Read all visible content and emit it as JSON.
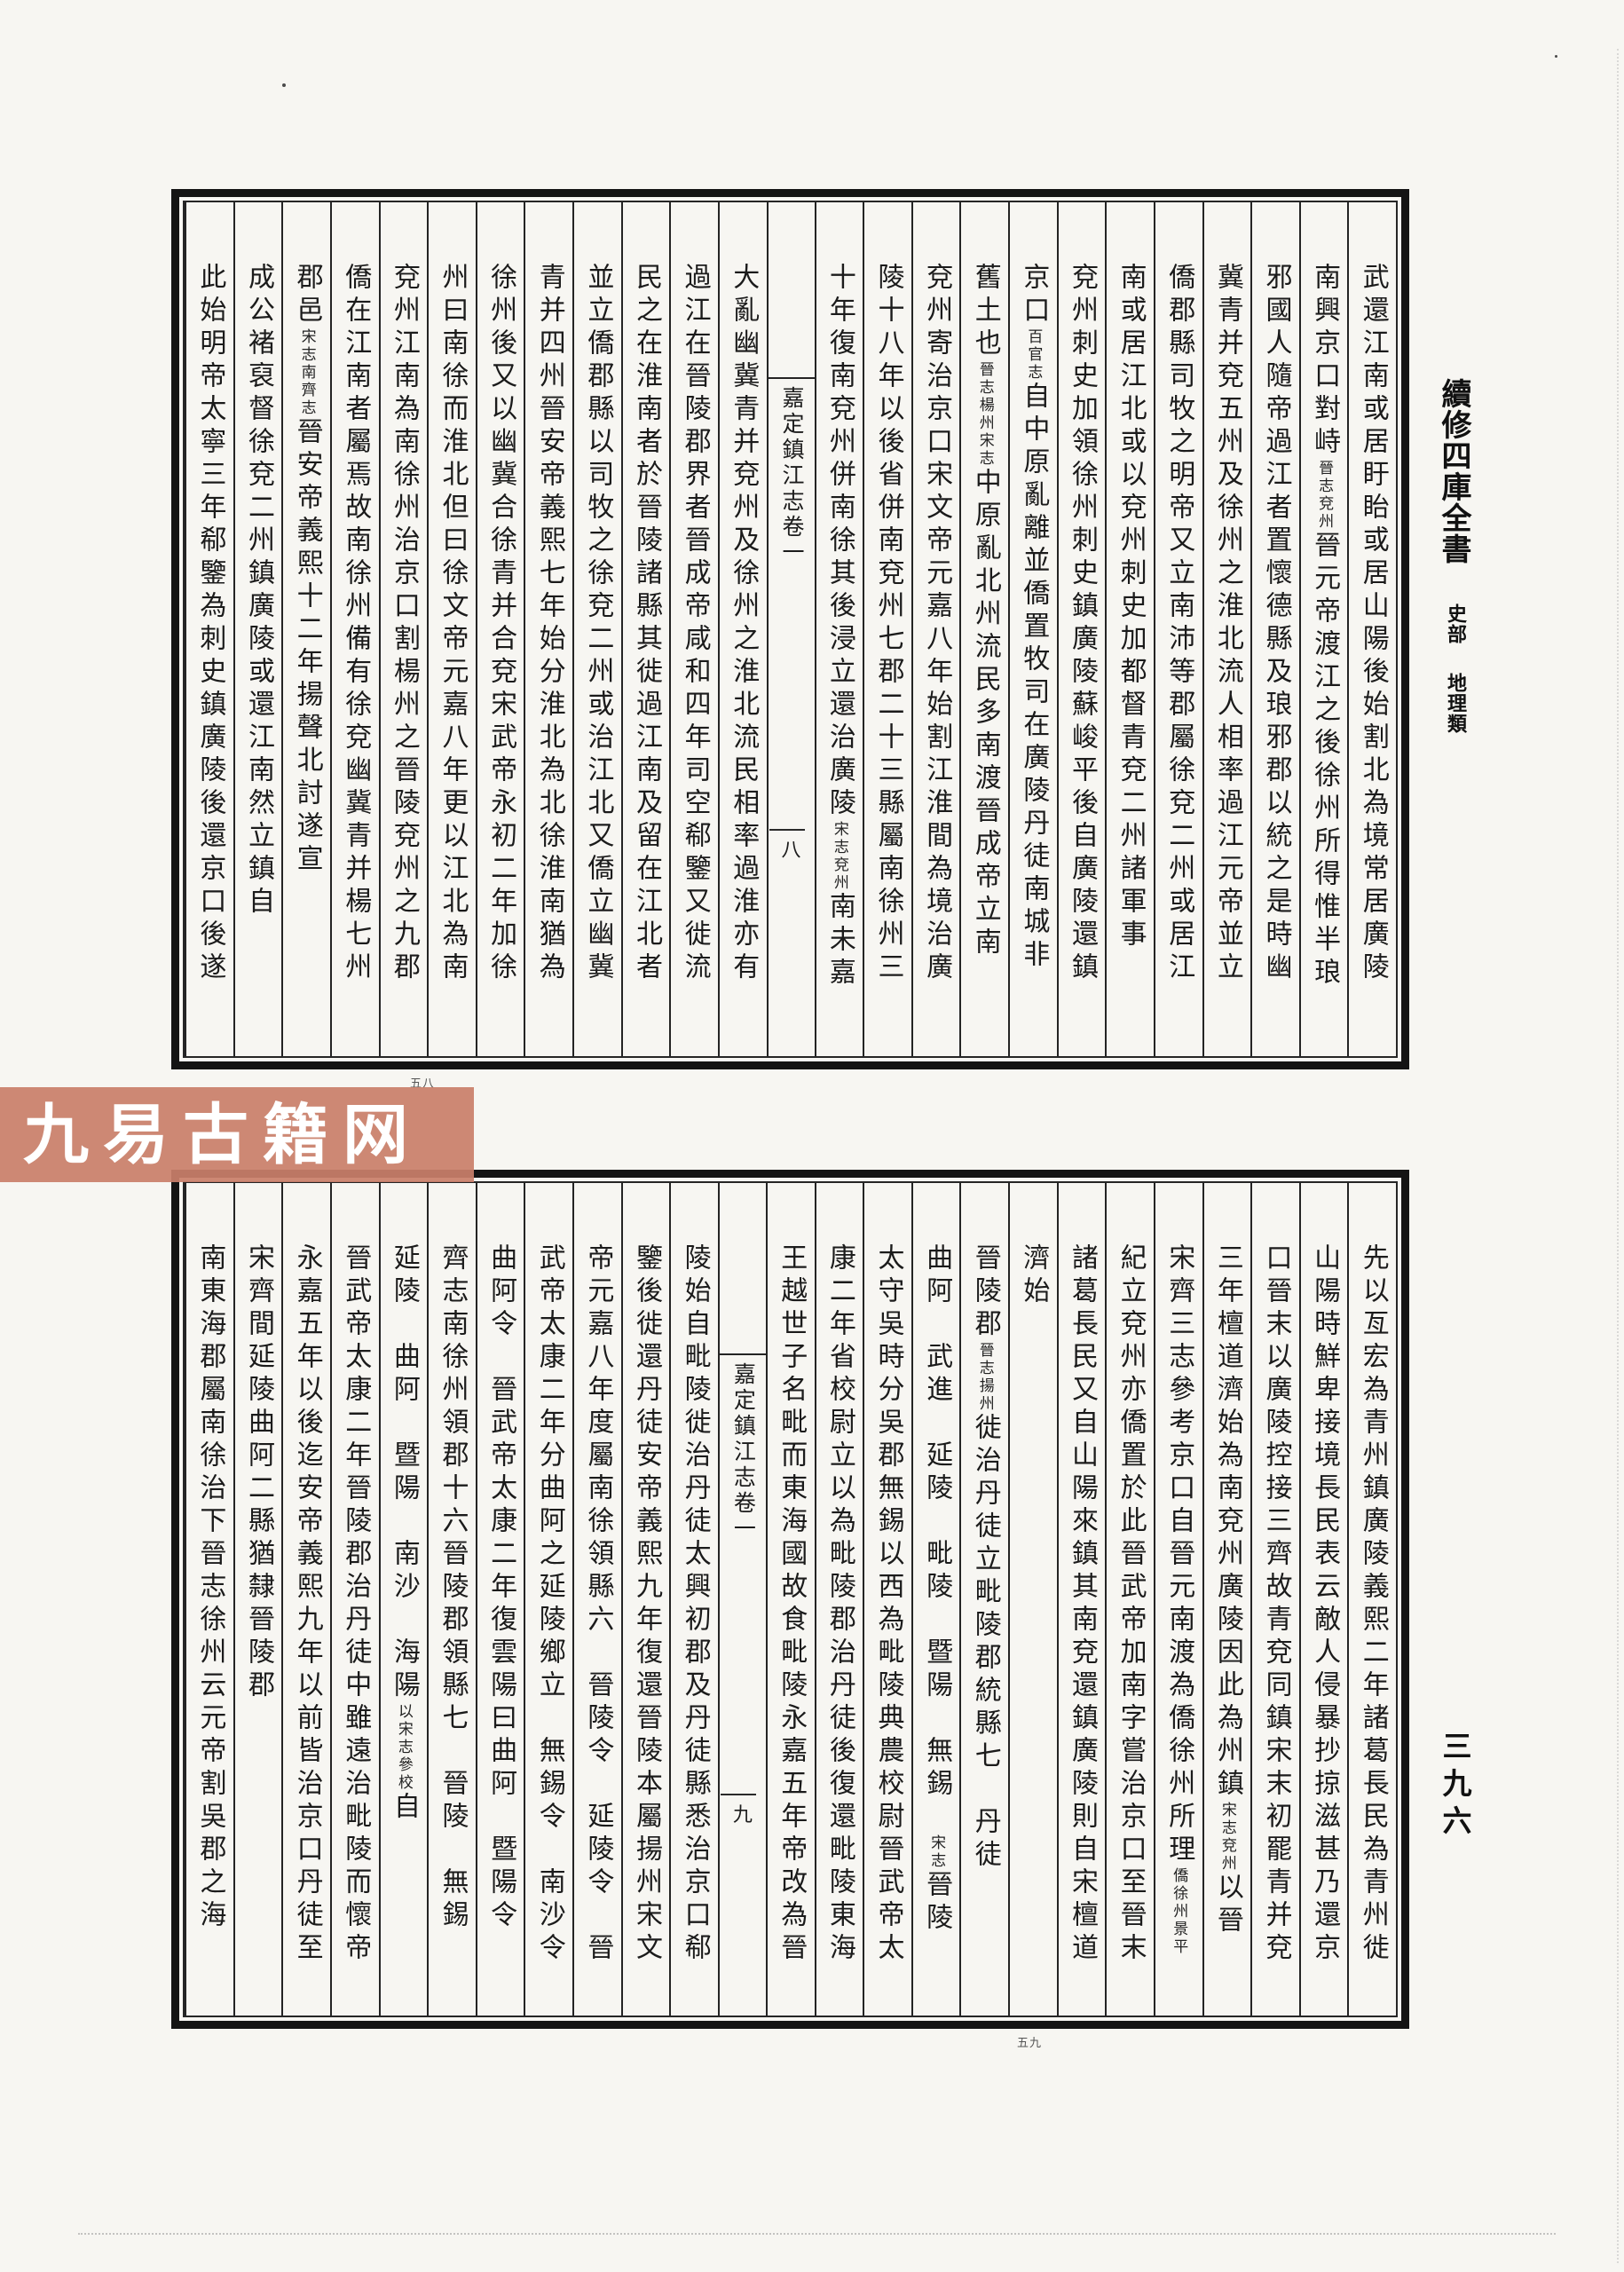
{
  "page": {
    "background": "#f7f6f2",
    "ink": "#1b1b1b"
  },
  "margin": {
    "series_title": "續修四庫全書",
    "section": "史部",
    "category": "地理類",
    "page_number": "三九六"
  },
  "watermark": {
    "text": "九易古籍网",
    "background": "#c97f6a",
    "foreground": "#ffffff"
  },
  "frames": [
    {
      "name": "upper",
      "fold_title": "嘉定鎮江志卷一",
      "fold_leaf_number": "八",
      "under_mark": "五八",
      "columns": [
        {
          "segs": [
            {
              "t": "武還江南或居盱眙或居山陽後始割北為境常居廣陵"
            }
          ]
        },
        {
          "segs": [
            {
              "t": "南興京口對峙"
            },
            {
              "t": "晉志兗州",
              "s": 1
            },
            {
              "t": "晉元帝渡江之後徐州所得惟半琅"
            }
          ]
        },
        {
          "segs": [
            {
              "t": "邪國人隨帝過江者置懷德縣及琅邪郡以統之是時幽"
            }
          ]
        },
        {
          "segs": [
            {
              "t": "冀青并兗五州及徐州之淮北流人相率過江元帝並立"
            }
          ]
        },
        {
          "segs": [
            {
              "t": "僑郡縣司牧之明帝又立南沛等郡屬徐兗二州或居江"
            }
          ]
        },
        {
          "segs": [
            {
              "t": "南或居江北或以兗州刺史加都督青兗二州諸軍事"
            }
          ]
        },
        {
          "segs": [
            {
              "t": "兗州刺史加領徐州刺史鎮廣陵蘇峻平後自廣陵還鎮"
            }
          ]
        },
        {
          "segs": [
            {
              "t": "京口"
            },
            {
              "t": "百官志",
              "s": 1
            },
            {
              "t": "自中原亂離並僑置牧司在廣陵丹徒南城非"
            }
          ]
        },
        {
          "segs": [
            {
              "t": "舊土也"
            },
            {
              "t": "晉志楊州宋志",
              "s": 1
            },
            {
              "t": "中原亂北州流民多南渡晉成帝立南"
            }
          ]
        },
        {
          "segs": [
            {
              "t": "兗州寄治京口宋文帝元嘉八年始割江淮間為境治廣"
            }
          ]
        },
        {
          "segs": [
            {
              "t": "陵十八年以後省併南兗州七郡二十三縣屬南徐州三"
            }
          ]
        },
        {
          "segs": [
            {
              "t": "十年復南兗州併南徐其後浸立還治廣陵"
            },
            {
              "t": "宋志兗州",
              "s": 1
            },
            {
              "t": "南未嘉"
            }
          ]
        },
        {
          "fold": true
        },
        {
          "segs": [
            {
              "t": "大亂幽冀青并兗州及徐州之淮北流民相率過淮亦有"
            }
          ]
        },
        {
          "segs": [
            {
              "t": "過江在晉陵郡界者晉成帝咸和四年司空郗鑒又徙流"
            }
          ]
        },
        {
          "segs": [
            {
              "t": "民之在淮南者於晉陵諸縣其徙過江南及留在江北者"
            }
          ]
        },
        {
          "segs": [
            {
              "t": "並立僑郡縣以司牧之徐兗二州或治江北又僑立幽冀"
            }
          ]
        },
        {
          "segs": [
            {
              "t": "青并四州晉安帝義熙七年始分淮北為北徐淮南猶為"
            }
          ]
        },
        {
          "segs": [
            {
              "t": "徐州後又以幽冀合徐青并合兗宋武帝永初二年加徐"
            }
          ]
        },
        {
          "segs": [
            {
              "t": "州曰南徐而淮北但曰徐文帝元嘉八年更以江北為南"
            }
          ]
        },
        {
          "segs": [
            {
              "t": "兗州江南為南徐州治京口割楊州之晉陵兗州之九郡"
            }
          ]
        },
        {
          "segs": [
            {
              "t": "僑在江南者屬焉故南徐州備有徐兗幽冀青并楊七州"
            }
          ]
        },
        {
          "segs": [
            {
              "t": "郡邑"
            },
            {
              "t": "宋志南齊志",
              "s": 1
            },
            {
              "t": "晉安帝義熙十二年揚聲北討遂宣"
            }
          ]
        },
        {
          "segs": [
            {
              "t": "成公褚裒督徐兗二州鎮廣陵或還江南然立鎮自"
            }
          ]
        },
        {
          "segs": [
            {
              "t": "此始明帝太寧三年郗鑒為刺史鎮廣陵後還京口後遂"
            }
          ]
        }
      ]
    },
    {
      "name": "lower",
      "fold_title": "嘉定鎮江志卷一",
      "fold_leaf_number": "九",
      "under_mark": "五九",
      "columns": [
        {
          "segs": [
            {
              "t": "先以亙宏為青州鎮廣陵義熙二年諸葛長民為青州徙"
            }
          ]
        },
        {
          "segs": [
            {
              "t": "山陽時鮮卑接境長民表云敵人侵暴抄掠滋甚乃還京"
            }
          ]
        },
        {
          "segs": [
            {
              "t": "口晉末以廣陵控接三齊故青兗同鎮宋末初罷青并兗"
            }
          ]
        },
        {
          "segs": [
            {
              "t": "三年檀道濟始為南兗州廣陵因此為州鎮"
            },
            {
              "t": "宋志兗州",
              "s": 1
            },
            {
              "t": "以晉"
            }
          ]
        },
        {
          "segs": [
            {
              "t": "宋齊三志參考京口自晉元南渡為僑徐州所理"
            },
            {
              "t": "僑徐州景平",
              "s": 1
            }
          ]
        },
        {
          "segs": [
            {
              "t": "紀立兗州亦僑置於此晉武帝加南字嘗治京口至晉末"
            }
          ]
        },
        {
          "segs": [
            {
              "t": "諸葛長民又自山陽來鎮其南兗還鎮廣陵則自宋檀道"
            }
          ]
        },
        {
          "segs": [
            {
              "t": "濟始"
            }
          ]
        },
        {
          "segs": [
            {
              "t": "晉陵郡"
            },
            {
              "t": "晉志揚州",
              "s": 1
            },
            {
              "t": "徙治丹徒立毗陵郡統縣七　丹徒"
            }
          ]
        },
        {
          "segs": [
            {
              "t": "曲阿　武進　延陵　毗陵　暨陽　無錫　"
            },
            {
              "t": "宋志",
              "s": 1
            },
            {
              "t": "晉陵"
            }
          ]
        },
        {
          "segs": [
            {
              "t": "太守吳時分吳郡無錫以西為毗陵典農校尉晉武帝太"
            }
          ]
        },
        {
          "segs": [
            {
              "t": "康二年省校尉立以為毗陵郡治丹徒後復還毗陵東海"
            }
          ]
        },
        {
          "segs": [
            {
              "t": "王越世子名毗而東海國故食毗陵永嘉五年帝改為晉"
            }
          ]
        },
        {
          "fold": true
        },
        {
          "segs": [
            {
              "t": "陵始自毗陵徙治丹徒太興初郡及丹徒縣悉治京口郗"
            }
          ]
        },
        {
          "segs": [
            {
              "t": "鑒後徙還丹徒安帝義熙九年復還晉陵本屬揚州宋文"
            }
          ]
        },
        {
          "segs": [
            {
              "t": "帝元嘉八年度屬南徐領縣六　晉陵令　延陵令　晉"
            }
          ]
        },
        {
          "segs": [
            {
              "t": "武帝太康二年分曲阿之延陵鄉立　無錫令　南沙令"
            }
          ]
        },
        {
          "segs": [
            {
              "t": "曲阿令　晉武帝太康二年復雲陽曰曲阿　暨陽令"
            }
          ]
        },
        {
          "segs": [
            {
              "t": "齊志南徐州領郡十六晉陵郡領縣七　晉陵　無錫"
            }
          ]
        },
        {
          "segs": [
            {
              "t": "延陵　曲阿　暨陽　南沙　海陽"
            },
            {
              "t": "以宋志參校",
              "s": 1
            },
            {
              "t": "自"
            }
          ]
        },
        {
          "segs": [
            {
              "t": "晉武帝太康二年晉陵郡治丹徒中雖遠治毗陵而懷帝"
            }
          ]
        },
        {
          "segs": [
            {
              "t": "永嘉五年以後迄安帝義熙九年以前皆治京口丹徒至"
            }
          ]
        },
        {
          "segs": [
            {
              "t": "宋齊間延陵曲阿二縣猶隸晉陵郡"
            }
          ]
        },
        {
          "segs": [
            {
              "t": "南東海郡屬南徐治下晉志徐州云元帝割吳郡之海"
            }
          ]
        }
      ]
    }
  ]
}
